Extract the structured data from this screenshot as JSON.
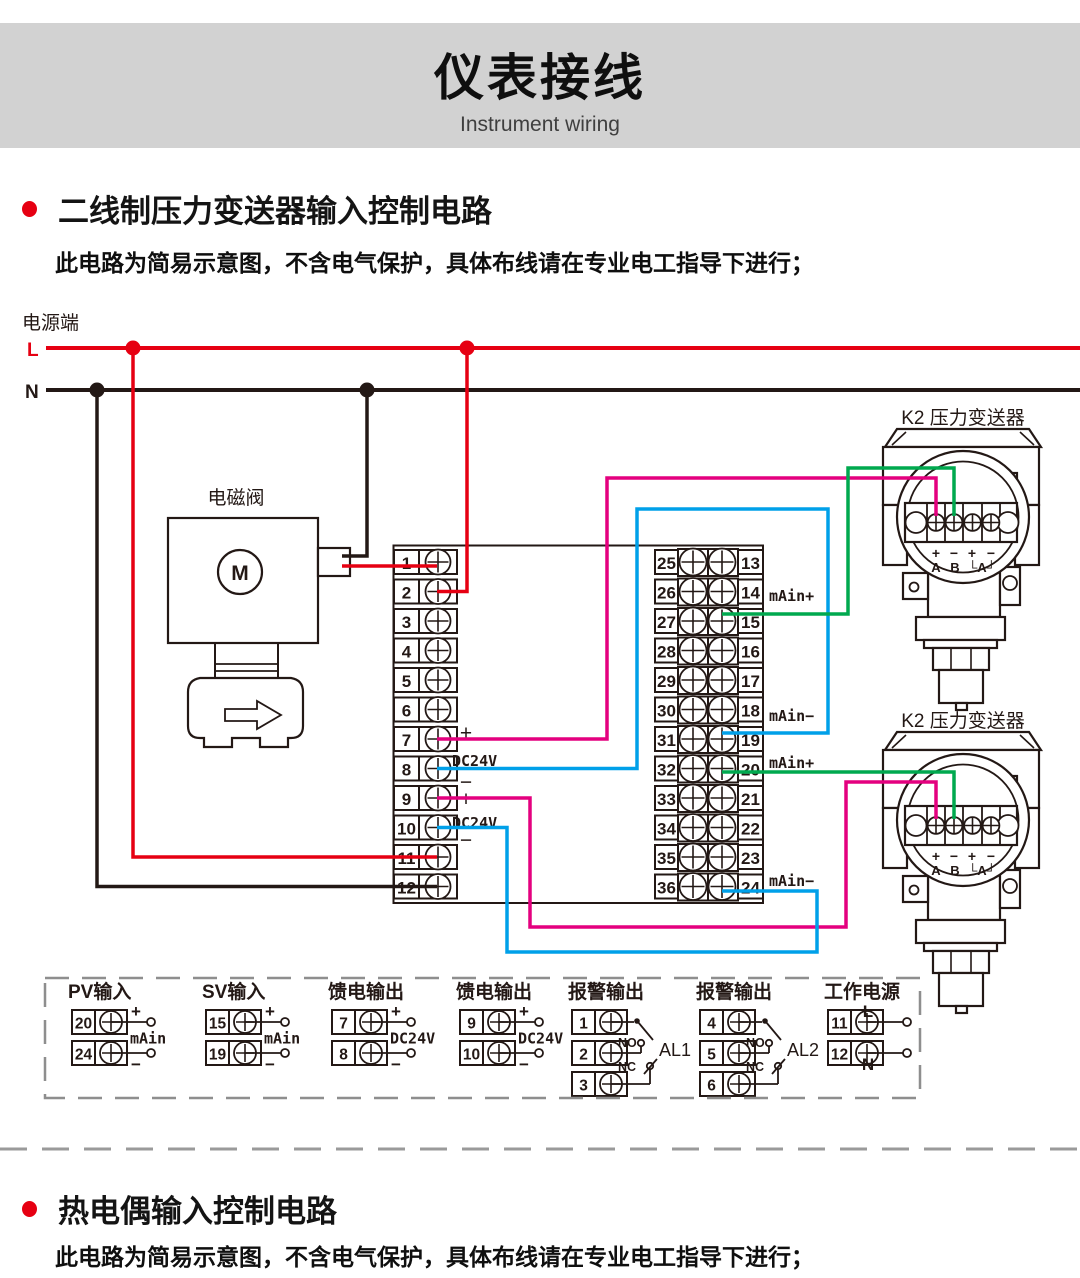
{
  "header": {
    "title": "仪表接线",
    "subtitle": "Instrument wiring"
  },
  "sections": [
    {
      "title": "二线制压力变送器输入控制电路",
      "note": "此电路为简易示意图，不含电气保护，具体布线请在专业电工指导下进行；"
    },
    {
      "title": "热电偶输入控制电路",
      "note": "此电路为简易示意图，不含电气保护，具体布线请在专业电工指导下进行；"
    }
  ],
  "colors": {
    "accent_red": "#e60012",
    "wire_red": "#e60012",
    "wire_magenta": "#e4007f",
    "wire_blue": "#00a0e9",
    "wire_green": "#00a94f",
    "line_black": "#231815",
    "band_gray": "#d2d2d2"
  },
  "diagram": {
    "power_label": "电源端",
    "line_l": "L",
    "line_n": "N",
    "solenoid_label": "电磁阀",
    "motor_label": "M",
    "transmitter_label": "K2 压力变送器",
    "tx_signs": [
      "+",
      "−",
      "+",
      "−"
    ],
    "tx_names": [
      "A",
      "B",
      "└A┘"
    ],
    "left_terminals": [
      "1",
      "2",
      "3",
      "4",
      "5",
      "6",
      "7",
      "8",
      "9",
      "10",
      "11",
      "12"
    ],
    "mid_terminals_left": [
      "25",
      "26",
      "27",
      "28",
      "29",
      "30",
      "31",
      "32",
      "33",
      "34",
      "35",
      "36"
    ],
    "mid_terminals_right": [
      "13",
      "14",
      "15",
      "16",
      "17",
      "18",
      "19",
      "20",
      "21",
      "22",
      "23",
      "24"
    ],
    "left_labels": [
      "+",
      "DC24V",
      "−",
      "+",
      "DC24V",
      "−"
    ],
    "mid_labels": [
      "mAin+",
      "mAin−",
      "mAin+",
      "mAin−"
    ]
  },
  "io_groups": [
    {
      "label": "PV输入",
      "terminals": [
        "20",
        "24"
      ],
      "top": "+",
      "mid": "mAin",
      "bottom": "−"
    },
    {
      "label": "SV输入",
      "terminals": [
        "15",
        "19"
      ],
      "top": "+",
      "mid": "mAin",
      "bottom": "−"
    },
    {
      "label": "馈电输出",
      "terminals": [
        "7",
        "8"
      ],
      "top": "+",
      "mid": "DC24V",
      "bottom": "−"
    },
    {
      "label": "馈电输出",
      "terminals": [
        "9",
        "10"
      ],
      "top": "+",
      "mid": "DC24V",
      "bottom": "−"
    },
    {
      "label": "报警输出",
      "terminals": [
        "1",
        "2",
        "3"
      ],
      "no": "NO",
      "nc": "NC",
      "name": "AL1"
    },
    {
      "label": "报警输出",
      "terminals": [
        "4",
        "5",
        "6"
      ],
      "no": "NO",
      "nc": "NC",
      "name": "AL2"
    },
    {
      "label": "工作电源",
      "terminals": [
        "11",
        "12"
      ],
      "top": "L",
      "bottom": "N"
    }
  ]
}
